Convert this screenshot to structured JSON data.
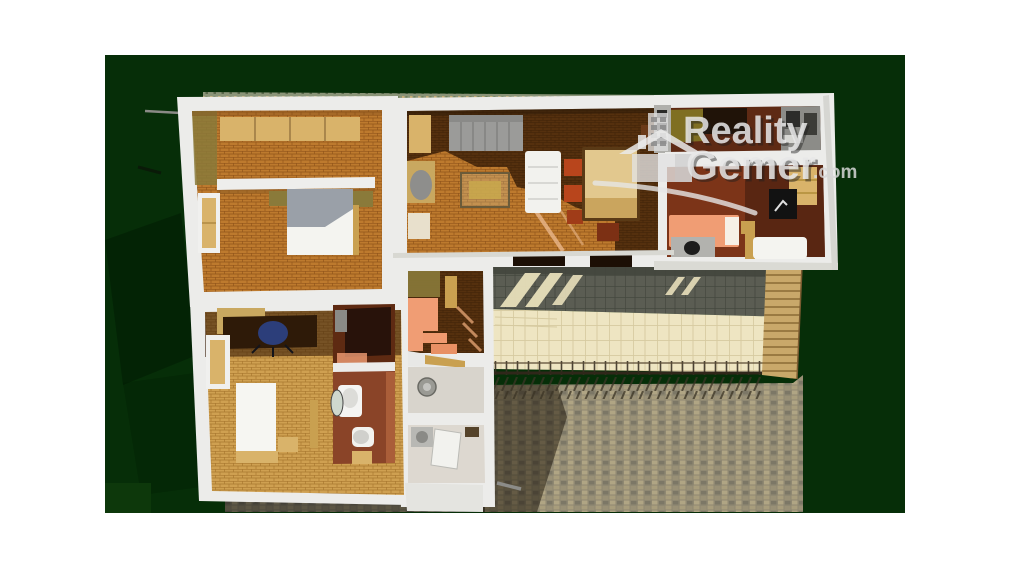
{
  "artwork": {
    "kind": "3d-floorplan-render",
    "matte": {
      "x": 105,
      "y": 55,
      "width": 800,
      "height": 458
    }
  },
  "watermark": {
    "line1": "Reality",
    "line2": "Gemer",
    "suffix": ".com",
    "icons": [
      "building-icon",
      "house-icon",
      "swoosh-icon"
    ],
    "text_color": "#e8e8e8"
  },
  "scene_elements": [
    "bedroom-top-left",
    "bedroom-bottom-left",
    "storage-room",
    "bathroom",
    "hallway-with-stairs",
    "utility-room",
    "laundry-room",
    "living-room",
    "kitchen",
    "bedroom-right",
    "driveway",
    "terrace",
    "railing",
    "side-steps",
    "cobblestone-courtyard",
    "roof-edge",
    "antenna"
  ],
  "palette": {
    "page_bg": "#ffffff",
    "matte_green": "#062e08",
    "wall_white": "#ececea",
    "brick_orange": "#bd7a2e",
    "brick_light": "#cfa051",
    "floor_dark_brown": "#55300e",
    "floor_red_brown": "#7c3418",
    "bath_red": "#8a4428",
    "kitchen_olive": "#7f6f22",
    "salmon": "#f09d74",
    "tan_wood": "#d9b36a",
    "terrace_beige": "#eee5c2",
    "pavement_gray": "#5b5d53",
    "cobble_tan": "#9b9277",
    "appliance_gray": "#8c8c88"
  }
}
